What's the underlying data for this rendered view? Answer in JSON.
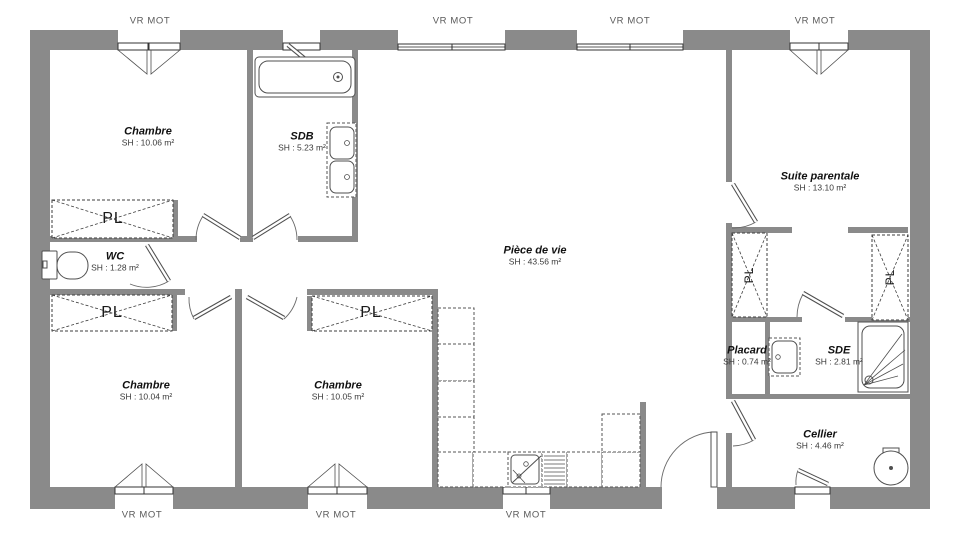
{
  "colors": {
    "wall": "#8a8a8a",
    "line": "#4f4f4f",
    "text": "#111111",
    "muted": "#5a5a5a"
  },
  "labels": {
    "shutter": "VR MOT",
    "closet": "PL"
  },
  "rooms": [
    {
      "name": "Chambre",
      "area": "SH : 10.06 m²"
    },
    {
      "name": "SDB",
      "area": "SH : 5.23 m²"
    },
    {
      "name": "Pièce de vie",
      "area": "SH : 43.56 m²"
    },
    {
      "name": "Suite parentale",
      "area": "SH : 13.10 m²"
    },
    {
      "name": "WC",
      "area": "SH : 1.28 m²"
    },
    {
      "name": "Chambre",
      "area": "SH : 10.04 m²"
    },
    {
      "name": "Chambre",
      "area": "SH : 10.05 m²"
    },
    {
      "name": "Placard",
      "area": "SH : 0.74 m²"
    },
    {
      "name": "SDE",
      "area": "SH : 2.81 m²"
    },
    {
      "name": "Cellier",
      "area": "SH : 4.46 m²"
    }
  ]
}
